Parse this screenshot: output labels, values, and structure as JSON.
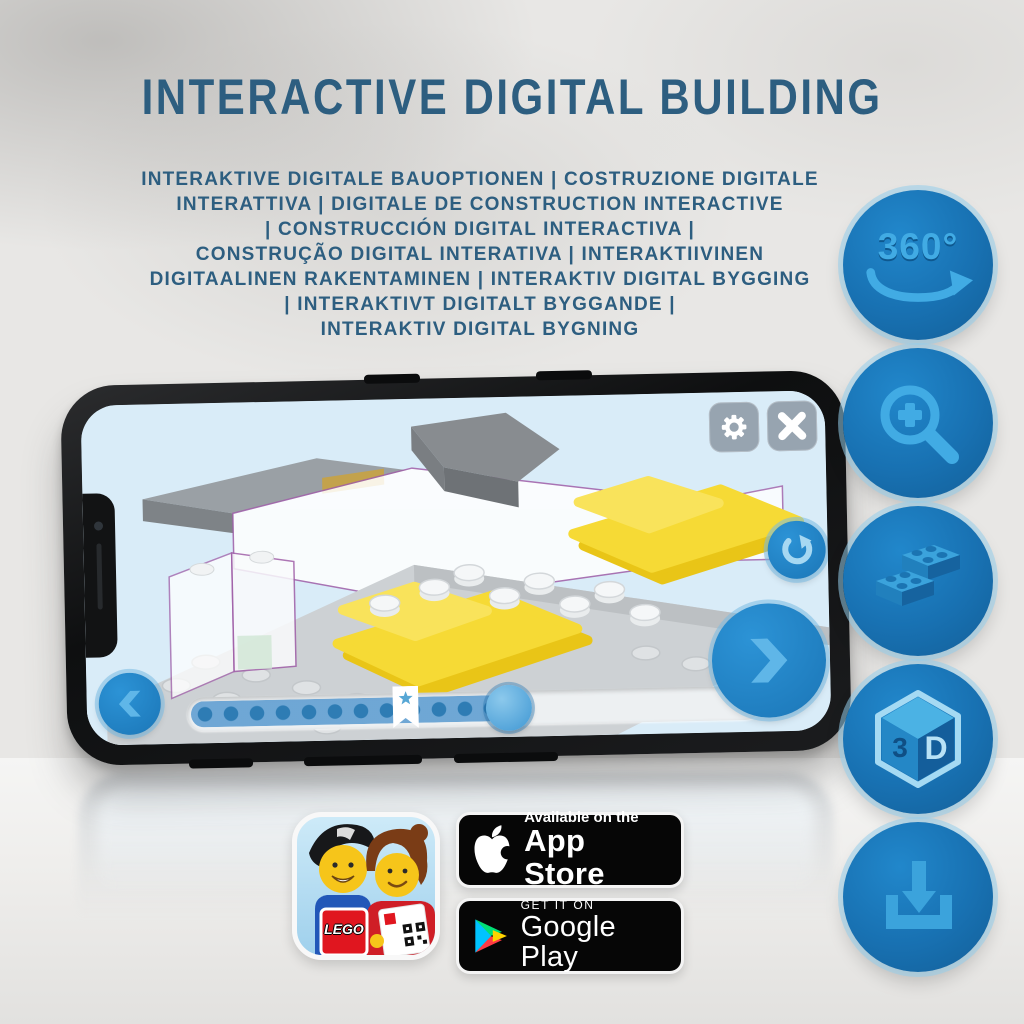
{
  "title": "INTERACTIVE DIGITAL BUILDING",
  "subtitle_lines": [
    "INTERAKTIVE DIGITALE BAUOPTIONEN | COSTRUZIONE DIGITALE",
    "INTERATTIVA | DIGITALE DE CONSTRUCTION INTERACTIVE",
    "| CONSTRUCCIÓN DIGITAL INTERACTIVA |",
    "CONSTRUÇÃO DIGITAL INTERATIVA | INTERAKTIIVINEN",
    "DIGITAALINEN RAKENTAMINEN | INTERAKTIV DIGITAL BYGGING",
    "| INTERAKTIVT DIGITALT BYGGANDE |",
    "INTERAKTIV DIGITAL BYGNING"
  ],
  "feature_icons": {
    "rotation_label": "360°",
    "cube_left": "3",
    "cube_right": "D",
    "list": [
      "360-rotation-icon",
      "zoom-in-icon",
      "lego-bricks-icon",
      "3d-cube-icon",
      "download-icon"
    ]
  },
  "phone": {
    "progress": {
      "fill_percent": 56,
      "bookmark_percent": 38,
      "step_dots": 20
    },
    "ui_icons": [
      "settings-gear-icon",
      "close-icon",
      "rotate-reset-icon",
      "prev-chevron-icon",
      "next-chevron-icon",
      "bookmark-star-icon"
    ]
  },
  "app_icon": {
    "logo_text": "LEGO"
  },
  "badges": {
    "app_store": {
      "tagline": "Available on the",
      "store": "App Store"
    },
    "google_play": {
      "tagline": "GET IT ON",
      "store": "Google Play"
    }
  },
  "colors": {
    "headline_blue": "#2d5e80",
    "icon_circle_blue": "#1b79bd",
    "icon_glyph_blue": "#41abe4",
    "lego_yellow": "#f6da35",
    "screen_blue": "#d9ecf8",
    "outline_purple": "#a05fa8",
    "badge_black": "#060606"
  }
}
